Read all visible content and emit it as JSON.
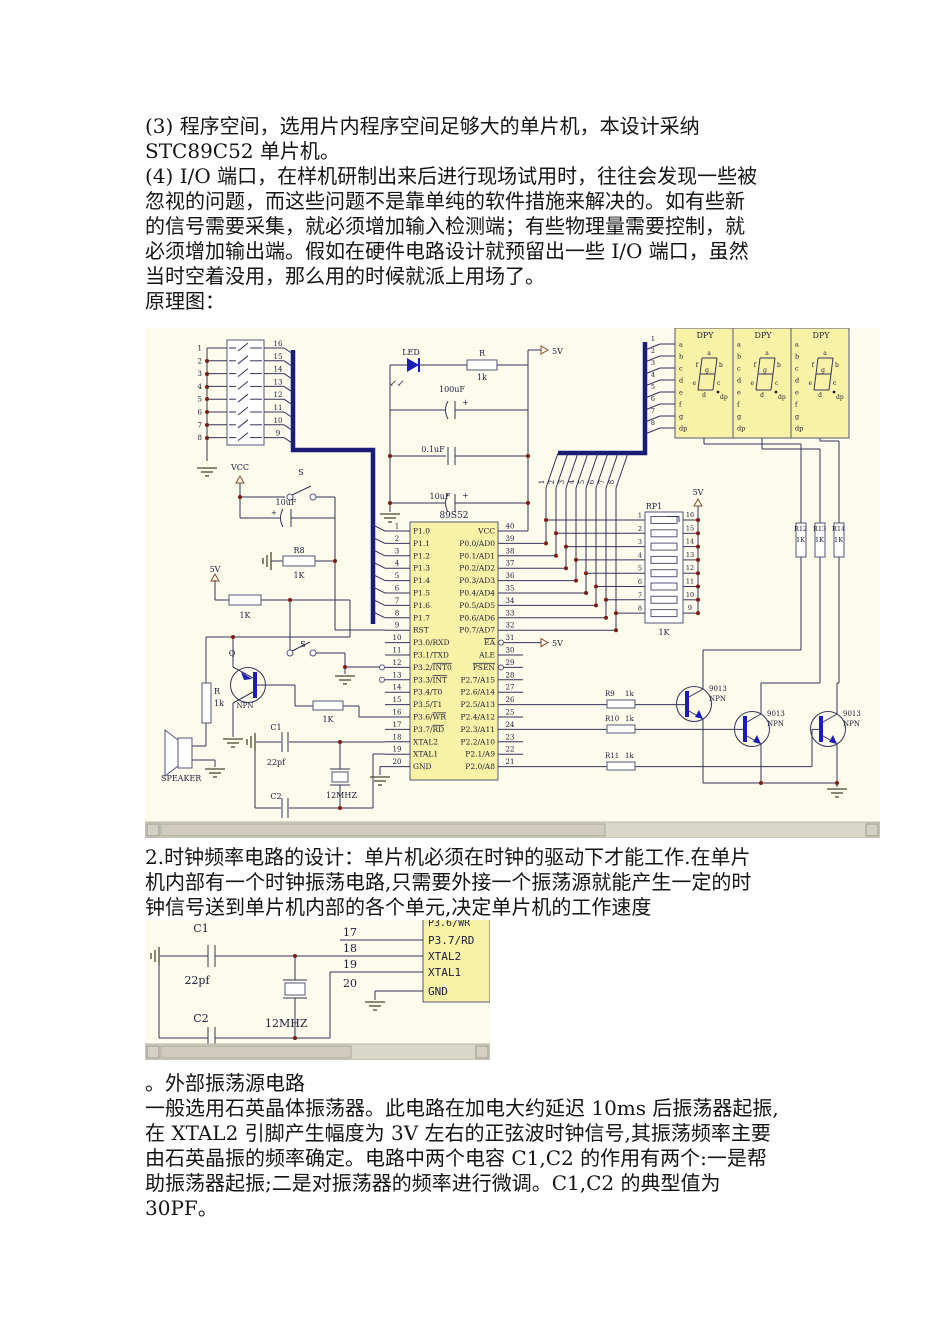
{
  "text": {
    "block1": [
      "(3) 程序空间，选用片内程序空间足够大的单片机，本设计采纳",
      "STC89C52 单片机。",
      "(4) I/O 端口，在样机研制出来后进行现场试用时，往往会发现一些被",
      "忽视的问题，而这些问题不是靠单纯的软件措施来解决的。如有些新",
      "的信号需要采集，就必须增加输入检测端；有些物理量需要控制，就",
      "必须增加输出端。假如在硬件电路设计就预留出一些 I/O 端口，虽然",
      "当时空着没用，那么用的时候就派上用场了。",
      "原理图："
    ],
    "block2": [
      "2.时钟频率电路的设计：单片机必须在时钟的驱动下才能工作.在单片",
      "机内部有一个时钟振荡电路,只需要外接一个振荡源就能产生一定的时",
      "钟信号送到单片机内部的各个单元,决定单片机的工作速度"
    ],
    "block3": [
      "。外部振荡源电路",
      "一般选用石英晶体振荡器。此电路在加电大约延迟 10ms 后振荡器起振,",
      "在 XTAL2 引脚产生幅度为 3V 左右的正弦波时钟信号,其振荡频率主要",
      "由石英晶振的频率确定。电路中两个电容 C1,C2 的作用有两个:一是帮",
      "助振荡器起振;二是对振荡器的频率进行微调。C1,C2 的典型值为",
      "30PF。"
    ]
  },
  "schematic": {
    "plus": "+",
    "mcu": {
      "title": "89S52",
      "left_pins": [
        {
          "num": "1",
          "pre": "P1.0"
        },
        {
          "num": "2",
          "pre": "P1.1"
        },
        {
          "num": "3",
          "pre": "P1.2"
        },
        {
          "num": "4",
          "pre": "P1.3"
        },
        {
          "num": "5",
          "pre": "P1.4"
        },
        {
          "num": "6",
          "pre": "P1.5"
        },
        {
          "num": "7",
          "pre": "P1.6"
        },
        {
          "num": "8",
          "pre": "P1.7"
        },
        {
          "num": "9",
          "pre": "RST"
        },
        {
          "num": "10",
          "pre": "P3.0/RXD"
        },
        {
          "num": "11",
          "pre": "P3.1/TXD"
        },
        {
          "num": "12",
          "pre": "P3.2/",
          "ov": "INT0",
          "bubble": true
        },
        {
          "num": "13",
          "pre": "P3.3/",
          "ov": "INT",
          "bubble": true
        },
        {
          "num": "14",
          "pre": "P3.4/T0"
        },
        {
          "num": "15",
          "pre": "P3.5/T1"
        },
        {
          "num": "16",
          "pre": "P3.6/",
          "ov": "WR"
        },
        {
          "num": "17",
          "pre": "P3.7/",
          "ov": "RD"
        },
        {
          "num": "18",
          "pre": "XTAL2"
        },
        {
          "num": "19",
          "pre": "XTAL1"
        },
        {
          "num": "20",
          "pre": "GND"
        }
      ],
      "right_pins": [
        {
          "num": "40",
          "pre": "VCC"
        },
        {
          "num": "39",
          "pre": "P0.0/AD0"
        },
        {
          "num": "38",
          "pre": "P0.1/AD1"
        },
        {
          "num": "37",
          "pre": "P0.2/AD2"
        },
        {
          "num": "36",
          "pre": "P0.3/AD3"
        },
        {
          "num": "35",
          "pre": "P0.4/AD4"
        },
        {
          "num": "34",
          "pre": "P0.5/AD5"
        },
        {
          "num": "33",
          "pre": "P0.6/AD6"
        },
        {
          "num": "32",
          "pre": "P0.7/AD7"
        },
        {
          "num": "31",
          "pre": "",
          "ov": "EA",
          "bubble": true
        },
        {
          "num": "30",
          "pre": "ALE"
        },
        {
          "num": "29",
          "pre": "",
          "ov": "PSEN",
          "bubble": true
        },
        {
          "num": "28",
          "pre": "P2.7/A15"
        },
        {
          "num": "27",
          "pre": "P2.6/A14"
        },
        {
          "num": "26",
          "pre": "P2.5/A13"
        },
        {
          "num": "25",
          "pre": "P2.4/A12"
        },
        {
          "num": "24",
          "pre": "P2.3/A11"
        },
        {
          "num": "23",
          "pre": "P2.2/A10"
        },
        {
          "num": "22",
          "pre": "P2.1/A9"
        },
        {
          "num": "21",
          "pre": "P2.0/A8"
        }
      ]
    },
    "dip_switch": {
      "left_pins": [
        "1",
        "2",
        "3",
        "4",
        "5",
        "6",
        "7",
        "8"
      ],
      "right_pins": [
        "16",
        "15",
        "14",
        "13",
        "12",
        "11",
        "10",
        "9"
      ]
    },
    "power": {
      "led": "LED",
      "arrows": "↙↙",
      "r": "R",
      "r_val": "1k",
      "cap1": "100uF",
      "cap2": "0.1uF",
      "cap3": "10uF",
      "v5": "5V"
    },
    "reset": {
      "vcc": "VCC",
      "sw": "S",
      "cap": "10uF",
      "r": "R8",
      "r_val": "1K"
    },
    "ea_v5": "5V",
    "bus_numbers": [
      "1",
      "2",
      "3",
      "4",
      "5",
      "6",
      "7",
      "8"
    ],
    "displays": {
      "title": "DPY",
      "pins": [
        "a",
        "b",
        "c",
        "d",
        "e",
        "f",
        "g",
        "dp"
      ],
      "pin_numbers": [
        "1",
        "2",
        "3",
        "4",
        "5",
        "6",
        "7",
        "8"
      ],
      "seg_labels": [
        "a",
        "b",
        "c",
        "d",
        "e",
        "f",
        "g",
        "dp"
      ]
    },
    "rp1": {
      "name": "RP1",
      "value": "1K",
      "v5": "5V",
      "left_pins": [
        "1",
        "2",
        "3",
        "4",
        "5",
        "6",
        "7",
        "8"
      ],
      "right_pins": [
        "16",
        "15",
        "14",
        "13",
        "12",
        "11",
        "10",
        "9"
      ]
    },
    "seg_resistors": [
      {
        "name": "R12",
        "value": "1K"
      },
      {
        "name": "R13",
        "value": "1K"
      },
      {
        "name": "R14",
        "value": "1K"
      }
    ],
    "base_resistors": [
      {
        "name": "R9",
        "value": "1k"
      },
      {
        "name": "R10",
        "value": "1k"
      },
      {
        "name": "R11",
        "value": "1k"
      }
    ],
    "transistors": [
      {
        "part": "9013",
        "type": "NPN"
      },
      {
        "part": "9013",
        "type": "NPN"
      },
      {
        "part": "9013",
        "type": "NPN"
      }
    ],
    "speaker_circuit": {
      "v5": "5V",
      "r_top": "1K",
      "q": "Q",
      "q_type": "NPN",
      "r": "R",
      "r_val": "1k",
      "speaker": "SPEAKER",
      "sw": "S",
      "r_base": "1K"
    },
    "crystal_circuit": {
      "c1": "C1",
      "c1_val": "22pf",
      "c2": "C2",
      "xtal": "12MHZ"
    }
  },
  "diagram2": {
    "partial_pin": "P3.6/WR",
    "pins": [
      {
        "num": "17",
        "label": "P3.7/RD"
      },
      {
        "num": "18",
        "label": "XTAL2"
      },
      {
        "num": "19",
        "label": "XTAL1"
      },
      {
        "num": "20",
        "label": "GND"
      }
    ],
    "c1": "C1",
    "c1_val": "22pf",
    "c2": "C2",
    "xtal": "12MHZ"
  },
  "colors": {
    "schematic_bg": "#fcfbec",
    "chip_fill": "#f8f2a6",
    "wire": "#34345c",
    "bus": "#1b1b78",
    "junction": "#7d1d12",
    "device_blue": "#1c1cb8",
    "scroll_track": "#d9d6ca",
    "scroll_thumb": "#cfccbe"
  }
}
